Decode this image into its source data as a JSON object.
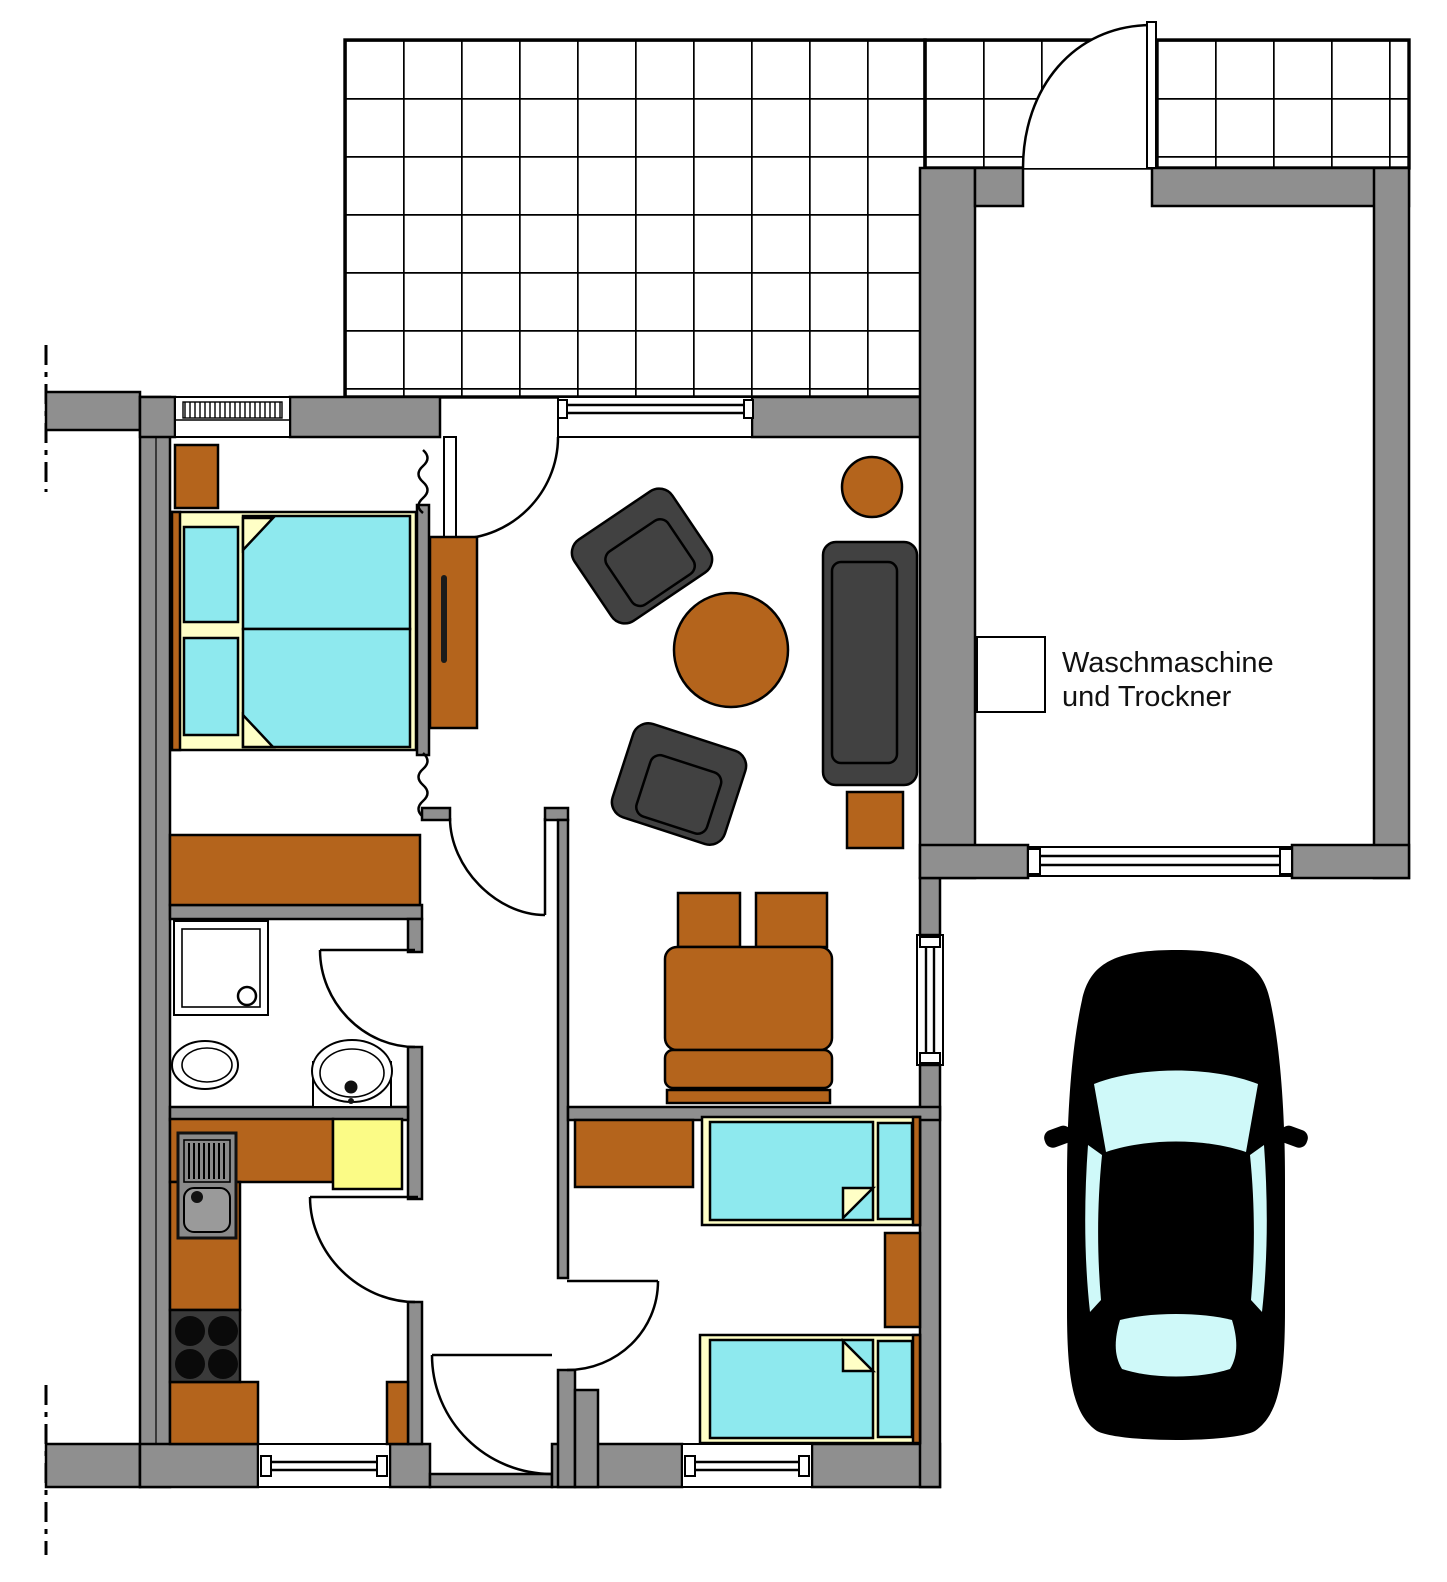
{
  "floorplan": {
    "annotation": {
      "line1": "Waschmaschine",
      "line2": "und Trockner"
    },
    "colors": {
      "wall_gray": "#8F8F8F",
      "wood_brown": "#B4641C",
      "mattress_cyan": "#8EE9EE",
      "linen_yellow": "#FFFFC6",
      "kitchen_table_yellow": "#FBFB86",
      "upholstery_dark_gray": "#414141",
      "car_body_black": "#000000",
      "car_glass_cyan": "#CFF9F9",
      "outline_black": "#000000",
      "background_white": "#FFFFFF"
    }
  }
}
